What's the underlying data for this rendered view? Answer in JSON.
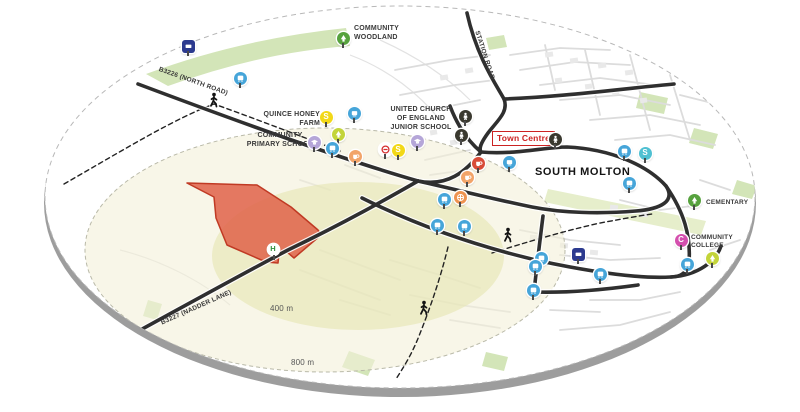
{
  "map": {
    "labels": {
      "community_woodland": "COMMUNITY\nWOODLAND",
      "quince_honey_farm": "QUINCE HONEY\nFARM",
      "community_primary_school": "COMMUNITY\nPRIMARY SCHOOL",
      "united_church_junior_school": "UNITED CHURCH\nOF ENGLAND\nJUNIOR SCHOOL",
      "town_centre": "Town Centre",
      "south_molton": "SOUTH MOLTON",
      "cementary": "CEMENTARY",
      "community_college": "COMMUNITY\nCOLLEGE",
      "road_b3226": "B3226 (NORTH ROAD)",
      "road_b3227": "B3227 (NADDER LANE)",
      "road_station": "STATION ROAD",
      "ring_400": "400 m",
      "ring_800": "800 m"
    },
    "colors": {
      "road": "#2f2f2f",
      "site_fill": "#e0664d",
      "site_stroke": "#c03a24",
      "ring_inner": "#e7e7b5",
      "ring_outer": "#f3f0d8",
      "green_space": "#d3e5b8",
      "cementary_strip": "#e6eecb",
      "town_centre_red": "#cc2222",
      "marker_blue": "#46a5d9",
      "marker_navy": "#2c3a8f",
      "marker_yellow": "#f2d818",
      "marker_yellowgreen": "#c3d43a",
      "marker_green": "#57a23e",
      "marker_lavender": "#b5a6d8",
      "marker_orange": "#f2a469",
      "marker_deeporange": "#ee9350",
      "marker_red": "#d84b38",
      "marker_teal": "#4fc0d2",
      "marker_magenta": "#d44fae",
      "marker_black": "#3a392f",
      "marker_white": "#ffffff",
      "hospital_green": "#2f8f3b"
    },
    "markers": [
      {
        "name": "bus-stop-sign",
        "icon": "sign",
        "color": "navy",
        "x": 188,
        "y": 46
      },
      {
        "name": "bus-stop",
        "icon": "bus",
        "color": "blue",
        "x": 240,
        "y": 78
      },
      {
        "name": "community-woodland-tree",
        "icon": "tree",
        "color": "green",
        "x": 343,
        "y": 38
      },
      {
        "name": "landmark",
        "icon": "landmark",
        "color": "blue",
        "x": 354,
        "y": 113
      },
      {
        "name": "shop",
        "icon": "letter",
        "letter": "S",
        "color": "yellow",
        "x": 326,
        "y": 117
      },
      {
        "name": "green-space",
        "icon": "tree",
        "color": "yellowgreen",
        "x": 338,
        "y": 134
      },
      {
        "name": "primary-school",
        "icon": "school",
        "color": "lavender",
        "x": 314,
        "y": 142
      },
      {
        "name": "bus-stop",
        "icon": "bus",
        "color": "blue",
        "x": 332,
        "y": 148
      },
      {
        "name": "cafe",
        "icon": "cup",
        "color": "orange",
        "x": 355,
        "y": 156
      },
      {
        "name": "no-entry",
        "icon": "noentry",
        "color": "white",
        "x": 385,
        "y": 149
      },
      {
        "name": "shop",
        "icon": "letter",
        "letter": "S",
        "color": "yellow",
        "x": 398,
        "y": 150
      },
      {
        "name": "junior-school",
        "icon": "school",
        "color": "lavender",
        "x": 417,
        "y": 141
      },
      {
        "name": "town-amenity",
        "icon": "person",
        "color": "black",
        "x": 465,
        "y": 116
      },
      {
        "name": "town-amenity",
        "icon": "person",
        "color": "black",
        "x": 461,
        "y": 135
      },
      {
        "name": "town-amenity",
        "icon": "person",
        "color": "black",
        "x": 555,
        "y": 139
      },
      {
        "name": "amenity",
        "icon": "landmark",
        "color": "blue",
        "x": 509,
        "y": 162
      },
      {
        "name": "pub",
        "icon": "cup",
        "color": "red",
        "x": 478,
        "y": 163
      },
      {
        "name": "cafe",
        "icon": "cup",
        "color": "orange",
        "x": 467,
        "y": 177
      },
      {
        "name": "pharmacy",
        "icon": "cross",
        "color": "deeporange",
        "x": 460,
        "y": 197
      },
      {
        "name": "bus-stop",
        "icon": "bus",
        "color": "blue",
        "x": 444,
        "y": 199
      },
      {
        "name": "bus-stop",
        "icon": "bus",
        "color": "blue",
        "x": 437,
        "y": 225
      },
      {
        "name": "bus-stop",
        "icon": "bus",
        "color": "blue",
        "x": 464,
        "y": 226
      },
      {
        "name": "bus-stop",
        "icon": "bus",
        "color": "blue",
        "x": 624,
        "y": 151
      },
      {
        "name": "shop",
        "icon": "letter",
        "letter": "S",
        "color": "teal",
        "x": 645,
        "y": 153
      },
      {
        "name": "bus-stop",
        "icon": "bus",
        "color": "blue",
        "x": 629,
        "y": 183
      },
      {
        "name": "cementary-tree",
        "icon": "tree",
        "color": "green",
        "x": 694,
        "y": 200
      },
      {
        "name": "community-college",
        "icon": "letter",
        "letter": "C",
        "color": "magenta",
        "x": 681,
        "y": 240
      },
      {
        "name": "green-space",
        "icon": "tree",
        "color": "yellowgreen",
        "x": 712,
        "y": 258
      },
      {
        "name": "bus-stop",
        "icon": "bus",
        "color": "blue",
        "x": 687,
        "y": 264
      },
      {
        "name": "bus-stop-sign",
        "icon": "sign",
        "color": "navy",
        "x": 578,
        "y": 254
      },
      {
        "name": "bus-stop",
        "icon": "bus",
        "color": "blue",
        "x": 541,
        "y": 258
      },
      {
        "name": "bus-stop",
        "icon": "bus",
        "color": "blue",
        "x": 535,
        "y": 266
      },
      {
        "name": "bus-stop",
        "icon": "bus",
        "color": "blue",
        "x": 600,
        "y": 274
      },
      {
        "name": "bus-stop",
        "icon": "bus",
        "color": "blue",
        "x": 533,
        "y": 290
      },
      {
        "name": "hospital",
        "icon": "hletter",
        "letter": "H",
        "color": "white",
        "x": 273,
        "y": 249
      }
    ],
    "pedestrians": [
      {
        "x": 214,
        "y": 100
      },
      {
        "x": 508,
        "y": 235
      },
      {
        "x": 424,
        "y": 308
      }
    ]
  }
}
